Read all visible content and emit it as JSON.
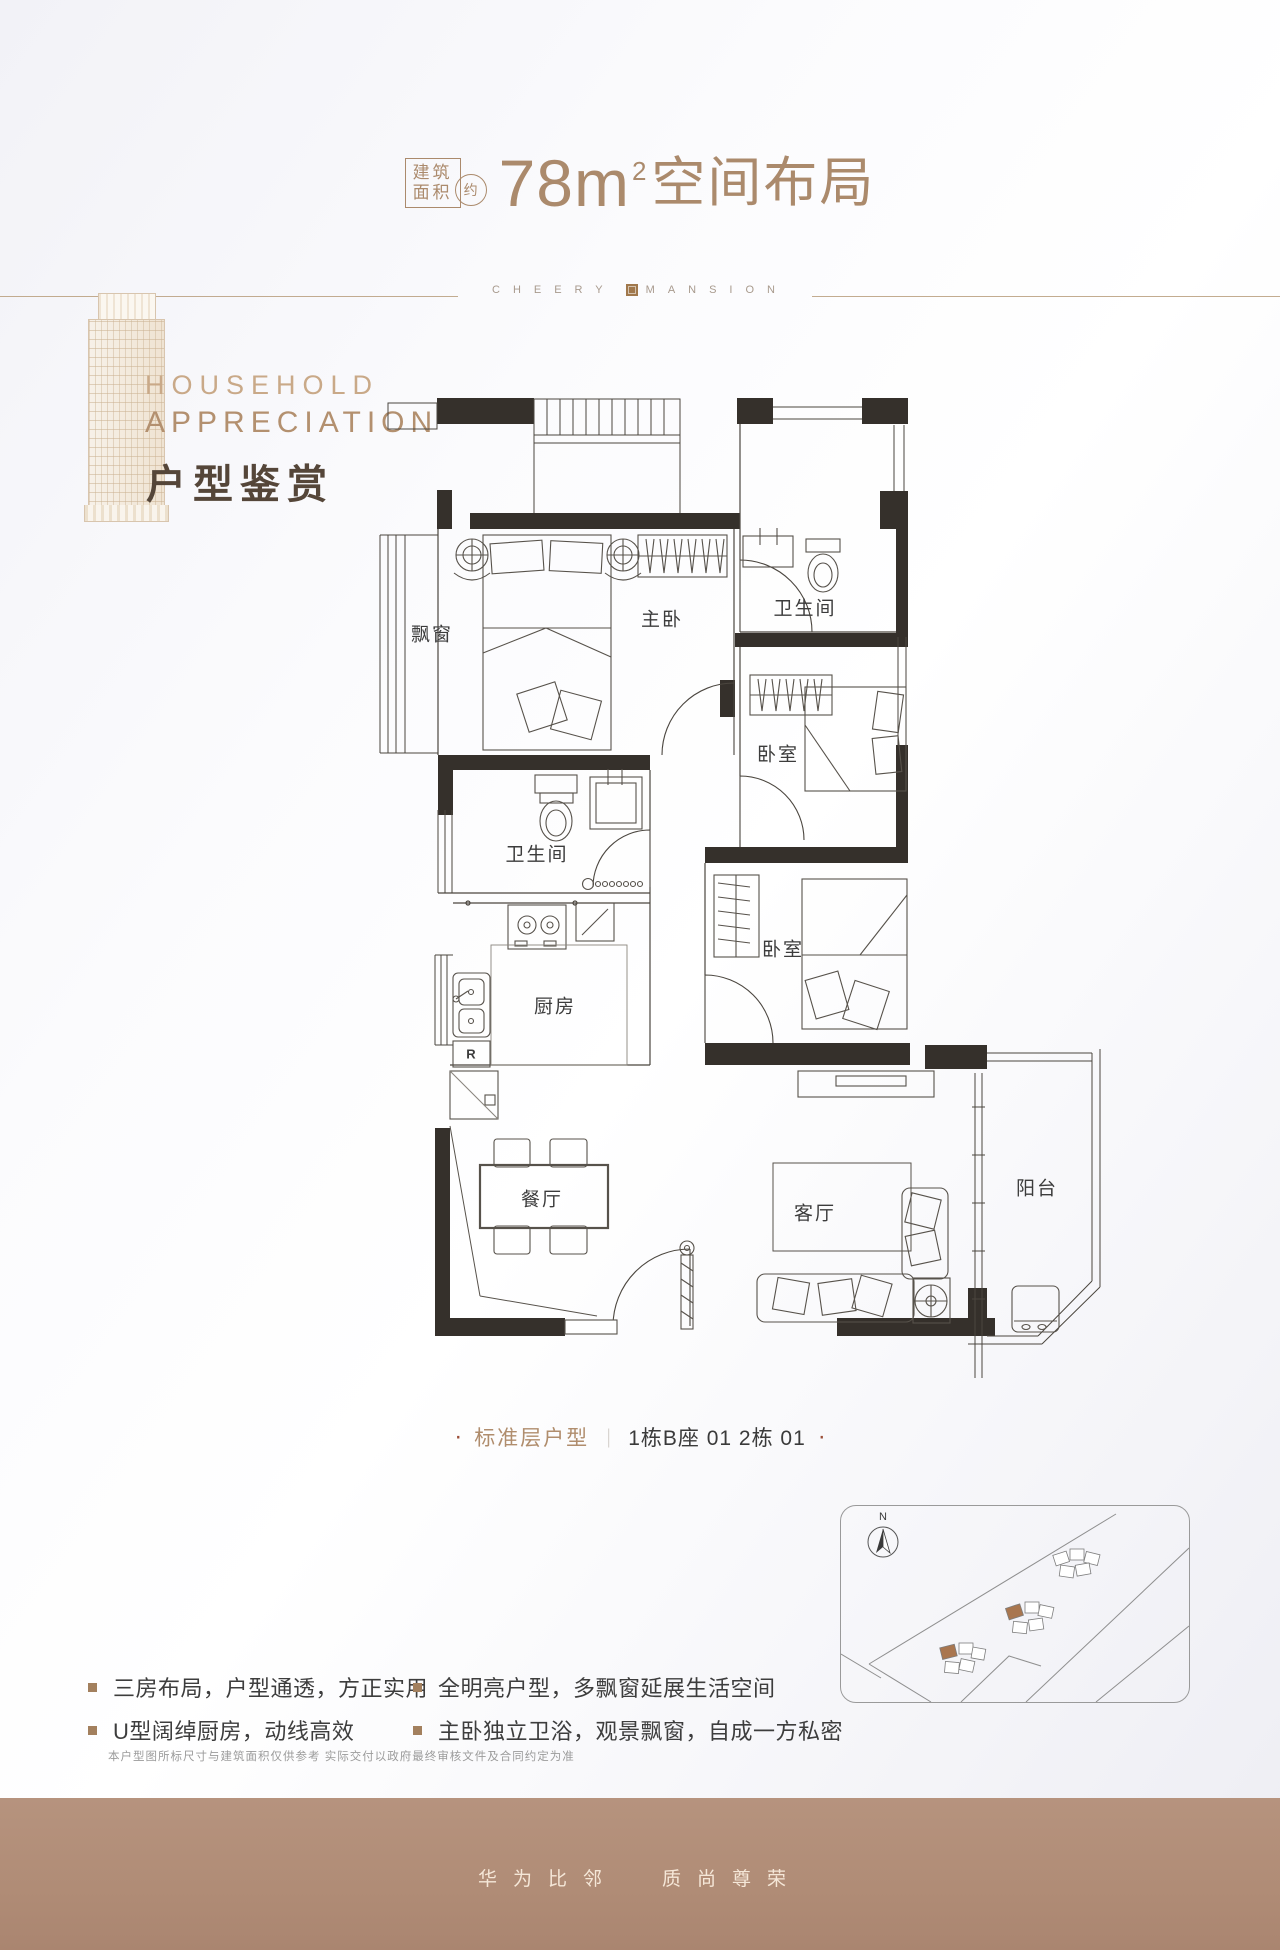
{
  "header": {
    "area_box_line1": "建筑",
    "area_box_line2": "面积",
    "approx": "约",
    "area_number": "78m",
    "area_sup": "2",
    "title_rest": "空间布局"
  },
  "brand": {
    "left": "CHEERY",
    "right": "MANSION"
  },
  "intro": {
    "line1": "HOUSEHOLD",
    "line2": "APPRECIATION",
    "line3": "户型鉴赏"
  },
  "floorplan": {
    "labels": [
      {
        "label": "飘窗"
      },
      {
        "label": "主卧"
      },
      {
        "label": "卫生间"
      },
      {
        "label": "卧室"
      },
      {
        "label": "卫生间"
      },
      {
        "label": "厨房"
      },
      {
        "label": "卧室"
      },
      {
        "label": "餐厅"
      },
      {
        "label": "客厅"
      },
      {
        "label": "阳台"
      }
    ],
    "fridge": "R"
  },
  "caption": {
    "dot_left": "·",
    "category": "标准层户型",
    "sep": "｜",
    "units": "1栋B座 01  2栋 01",
    "dot_right": "·"
  },
  "site_plan": {
    "north": "N"
  },
  "features": [
    {
      "text": "三房布局，户型通透，方正实用"
    },
    {
      "text": "U型阔绰厨房，动线高效"
    },
    {
      "text": "全明亮户型，多飘窗延展生活空间"
    },
    {
      "text": "主卧独立卫浴，观景飘窗，自成一方私密"
    }
  ],
  "disclaimer": "本户型图所标尺寸与建筑面积仅供参考  实际交付以政府最终审核文件及合同约定为准",
  "footer": {
    "slogan_left": "华为比邻",
    "slogan_right": "质尚尊荣"
  },
  "colors": {
    "accent": "#ab8a6c",
    "wall": "#35302b",
    "footer_bg": "#b08c76",
    "highlight": "#a9764f"
  }
}
